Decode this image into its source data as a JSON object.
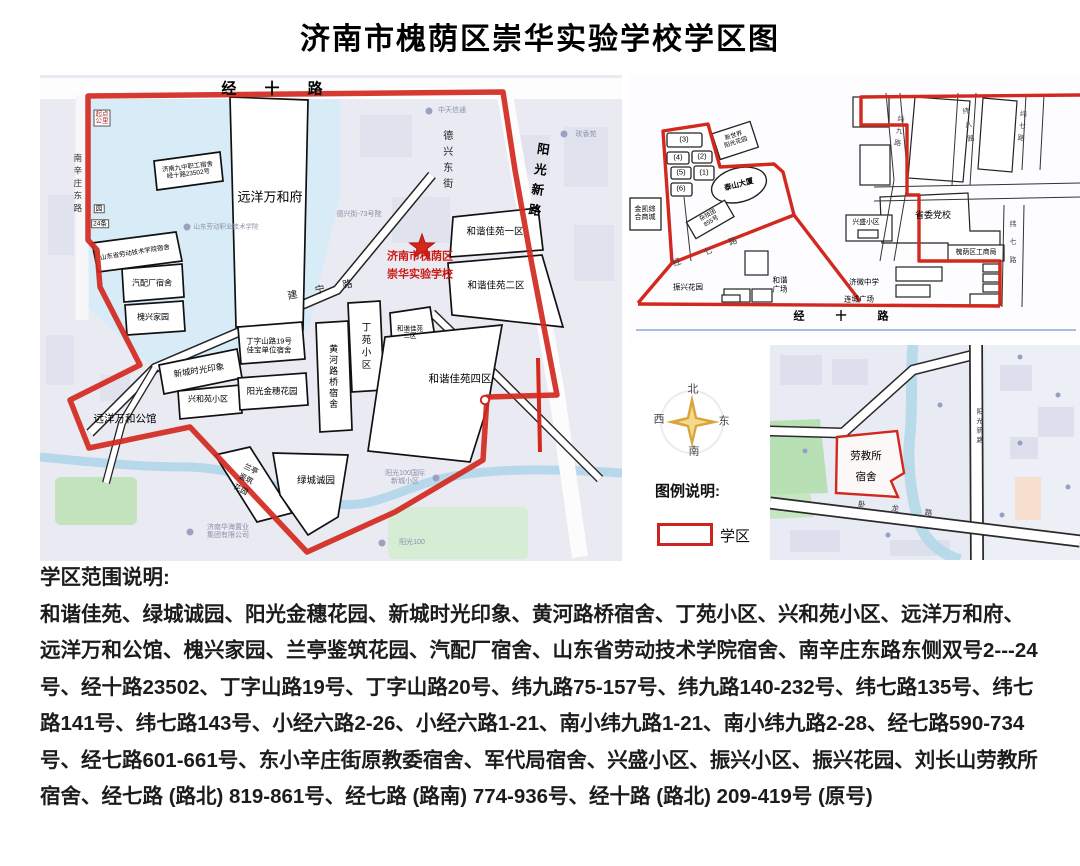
{
  "title": "济南市槐荫区崇华实验学校学区图",
  "legend": {
    "heading": "图例说明:",
    "district_label": "学区"
  },
  "compass": {
    "north": "北",
    "south": "南",
    "east": "东",
    "west": "西"
  },
  "colors": {
    "district_red": "#d2281e"
  },
  "main_map": {
    "school_marker": {
      "line1": "济南市槐荫区",
      "line2": "崇华实验学校"
    },
    "roads": {
      "jingshi_lu": "经 十 路",
      "nanxinzhuang_donglu": "南辛庄东路",
      "dexing_dongjie": "德兴东街",
      "yangguang_xinlu": "阳光新路",
      "jianning_lu": "建宁路"
    },
    "parcels": {
      "yuanyang_wanhefu": "远洋万和府",
      "jiuzhong_line1": "济南九中职工宿舍",
      "jiuzhong_line2": "经十路23502号",
      "laodong_xueyuan": "山东省劳动技术学院宿舍",
      "qipeichang": "汽配厂宿舍",
      "huaixing_jiayuan": "槐兴家园",
      "xincheng_shiguang": "新城时光印象",
      "dingzishan_line1": "丁字山路19号",
      "dingzishan_line2": "佳宝单位宿舍",
      "xingheyuan": "兴和苑小区",
      "yangguang_jinsui": "阳光金穗花园",
      "huanghe_luqiao": "黄河路桥宿舍",
      "dingyuan": "丁苑小区",
      "hexie_1": "和谐佳苑一区",
      "hexie_2": "和谐佳苑二区",
      "hexie_3_line1": "和谐佳苑",
      "hexie_3_line2": "三区",
      "hexie_4": "和谐佳苑四区",
      "lanting_line1": "兰亭",
      "lanting_line2": "鉴筑",
      "lanting_line3": "花园",
      "lvcheng": "绿城诚园",
      "yuanyang_gongguan": "远洋万和公馆"
    },
    "base_labels": {
      "qidian_line1": "起点",
      "qidian_line2": "公里",
      "yuan_box": "园",
      "tiao24_box": "24条",
      "zhongtian": "中天信通",
      "meixiangyuan": "玫香苑",
      "dexingjie_73": "德兴街-73号院",
      "laodong_zhiye": "山东劳动职业技术学院",
      "yangguang100_guoji_line1": "阳光100国际",
      "yangguang100_guoji_line2": "新城小区",
      "huahai_line1": "济南华海置业",
      "huahai_line2": "集团有限公司",
      "yangguang100": "阳光100"
    }
  },
  "inset_schematic": {
    "numbered_plots": [
      "(3)",
      "(4)",
      "(2)",
      "(5)",
      "(1)",
      "(6)"
    ],
    "taishan_dasha": "泰山大厦",
    "zajituan_line1": "杂技团",
    "zajituan_line2": "855号",
    "xinshijie_line1": "新世界",
    "xinshijie_line2": "阳光花园",
    "jinkai_line1": "金凯综",
    "jinkai_line2": "合商城",
    "zhenxing_huayuan": "振兴花园",
    "hexie_gc_line1": "和谐",
    "hexie_gc_line2": "广场",
    "shengwei_dangxiao": "省委党校",
    "gongshangju": "槐荫区工商局",
    "jiwei_zhongxue": "济微中学",
    "liancheng_guangchang": "连城广场",
    "xingsheng_xiaoqu": "兴盛小区",
    "roads": {
      "jingshi_lu": "经 十 路",
      "jingqi_lu": "经七路",
      "weijiu_lu": "纬九路",
      "weiba_lu": "纬八路",
      "weiqi_lu_a": "纬七路",
      "weiqi_lu_b": "纬七路"
    }
  },
  "inset_site": {
    "laojiao_line1": "劳教所",
    "laojiao_line2": "宿舍",
    "roads": {
      "yangguang_xinlu": "阳光新路",
      "wolong_lu": "卧 龙 路"
    }
  },
  "description": {
    "heading": "学区范围说明:",
    "lines": [
      "和谐佳苑、绿城诚园、阳光金穗花园、新城时光印象、黄河路桥宿舍、丁苑小区、兴和苑小区、远洋万和府、",
      "远洋万和公馆、槐兴家园、兰亭鉴筑花园、汽配厂宿舍、山东省劳动技术学院宿舍、南辛庄东路东侧双号2---24",
      "号、经十路23502、丁字山路19号、丁字山路20号、纬九路75-157号、纬九路140-232号、纬七路135号、纬七",
      "路141号、纬七路143号、小经六路2-26、小经六路1-21、南小纬九路1-21、南小纬九路2-28、经七路590-734",
      "号、经七路601-661号、东小辛庄街原教委宿舍、军代局宿舍、兴盛小区、振兴小区、振兴花园、刘长山劳教所",
      "宿舍、经七路 (路北) 819-861号、经七路 (路南) 774-936号、经十路 (路北) 209-419号 (原号)"
    ]
  }
}
